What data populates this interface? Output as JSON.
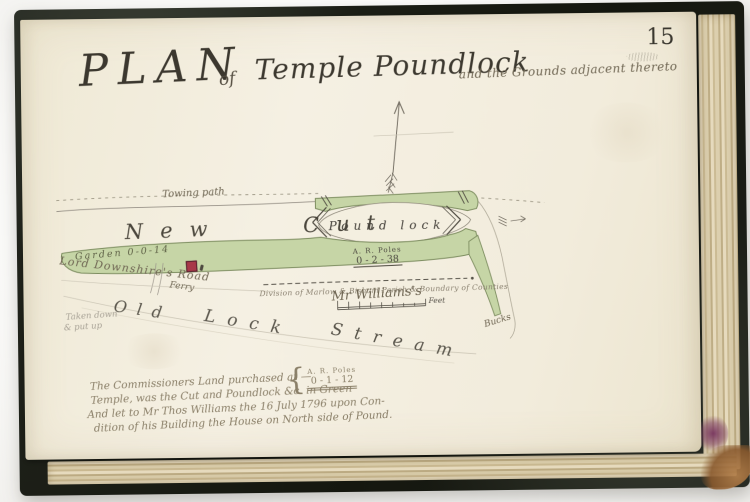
{
  "book": {
    "page_number": "15",
    "cover_color": "#1b1e16",
    "page_color": "#f2ecdc"
  },
  "title": {
    "word_plan": "PLAN",
    "word_of": "of",
    "subject": "Temple Poundlock",
    "tail": "and the Grounds adjacent thereto"
  },
  "map": {
    "towing_path": "Towing path",
    "new_cut": "New Cut",
    "pound_lock": "Pound lock",
    "garden": "Garden 0-0-14",
    "downshire_road": "Lord Downshire's Road",
    "ferry": "Ferry",
    "area_label": "A. R. Poles",
    "area_value": "0 - 2 - 38",
    "division": "Division of Marlow & Bisham Parish & Boundary of Counties",
    "mr_williams": "Mr Williams's",
    "scale_label": "Feet",
    "stream_w1": "Old",
    "stream_w2": "Lock",
    "stream_w3": "Stream",
    "bucks": "Bucks",
    "pencil_line1": "Taken down",
    "pencil_line2": "& put up",
    "green_hex": "#c6d5a6",
    "house_hex": "#a83848"
  },
  "notes": {
    "line1": "The Commissioners Land purchased at —",
    "line2": "Temple, was the Cut and Poundlock &c. in Green",
    "line3": "And let to Mr Thos Williams the 16 July 1796 upon Con-",
    "line4": "dition of his Building the House on North side of Pound.",
    "area_label": "A. R. Poles",
    "area_value": "0 - 1 - 12"
  }
}
